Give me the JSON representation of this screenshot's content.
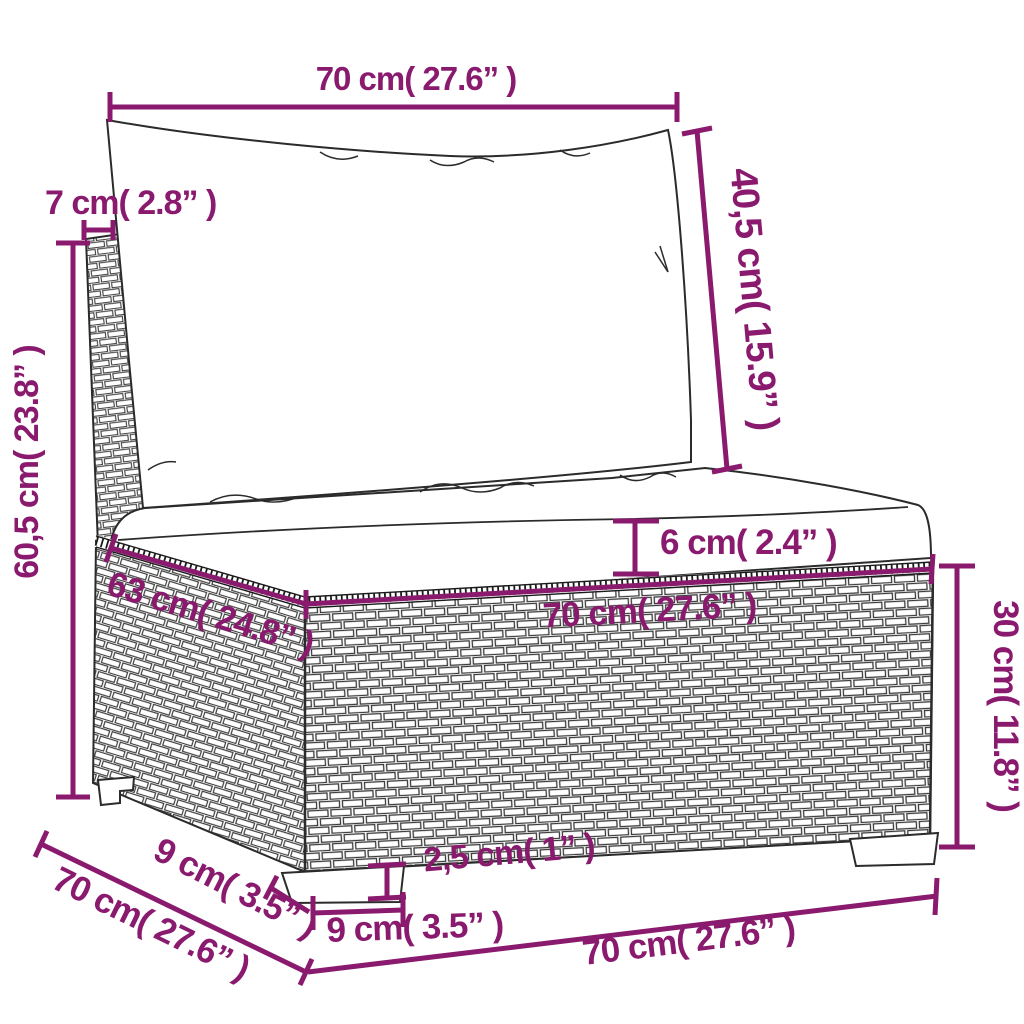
{
  "diagram": {
    "subject": "poly-rattan-garden-middle-sofa-dimension-drawing",
    "accent_color": "#8A1A6E",
    "line_color": "#2B2B2B",
    "background": "#FFFFFF",
    "dimensions": {
      "back_width": "70 cm( 27.6” )",
      "back_thickness": "7 cm( 2.8” )",
      "back_cushion_height": "40,5 cm( 15.9” )",
      "total_height": "60,5 cm( 23.8” )",
      "seat_cushion_thickness": "6 cm( 2.4” )",
      "seat_depth": "63 cm( 24.8” )",
      "seat_width": "70 cm( 27.6” )",
      "base_height": "30 cm( 11.8” )",
      "foot_height": "2,5 cm( 1” )",
      "foot_width": "9 cm( 3.5” )",
      "foot_depth": "9 cm( 3.5” )",
      "total_depth": "70 cm( 27.6” )",
      "bottom_width": "70 cm( 27.6” )"
    }
  }
}
